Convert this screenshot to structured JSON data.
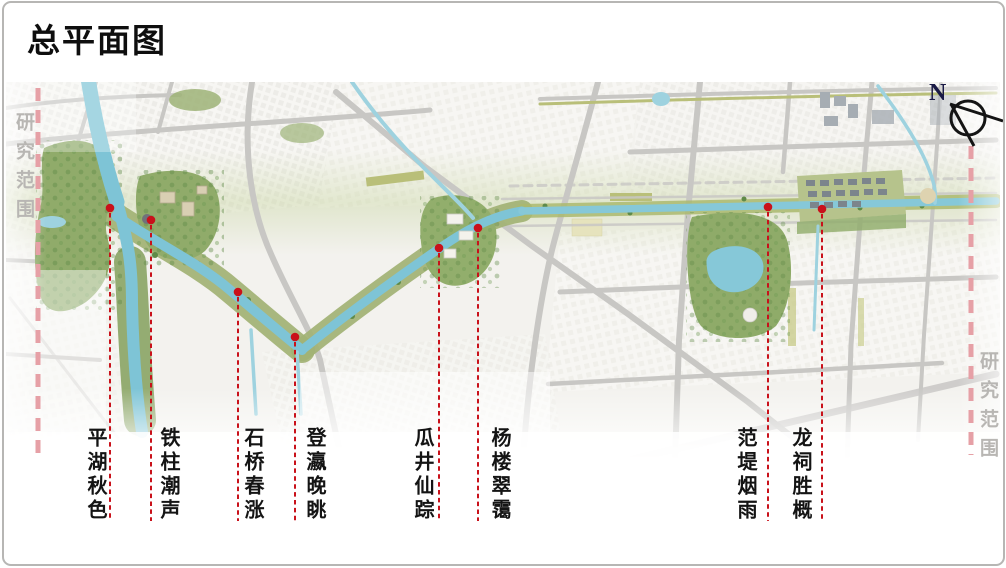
{
  "slide": {
    "title": "总平面图"
  },
  "map": {
    "compass_label": "N",
    "boundary_label": "研究范围"
  },
  "colors": {
    "red": "#c9111a",
    "pink": "#e6a0a6",
    "boundary_text": "#b8b6b3",
    "water": "#7ec4d6",
    "park_green": "#90ab6a",
    "road_gray": "#c8c7c4"
  },
  "spots": [
    {
      "name": "平湖秋色",
      "x": 110,
      "dot_y": 208,
      "label_x": 95
    },
    {
      "name": "铁柱潮声",
      "x": 151,
      "dot_y": 220,
      "label_x": 168
    },
    {
      "name": "石桥春涨",
      "x": 238,
      "dot_y": 292,
      "label_x": 252
    },
    {
      "name": "登瀛晚眺",
      "x": 295,
      "dot_y": 337,
      "label_x": 314
    },
    {
      "name": "瓜井仙踪",
      "x": 439,
      "dot_y": 248,
      "label_x": 422
    },
    {
      "name": "杨楼翠霭",
      "x": 478,
      "dot_y": 228,
      "label_x": 499
    },
    {
      "name": "范堤烟雨",
      "x": 768,
      "dot_y": 207,
      "label_x": 745
    },
    {
      "name": "龙祠胜概",
      "x": 822,
      "dot_y": 209,
      "label_x": 800
    }
  ]
}
